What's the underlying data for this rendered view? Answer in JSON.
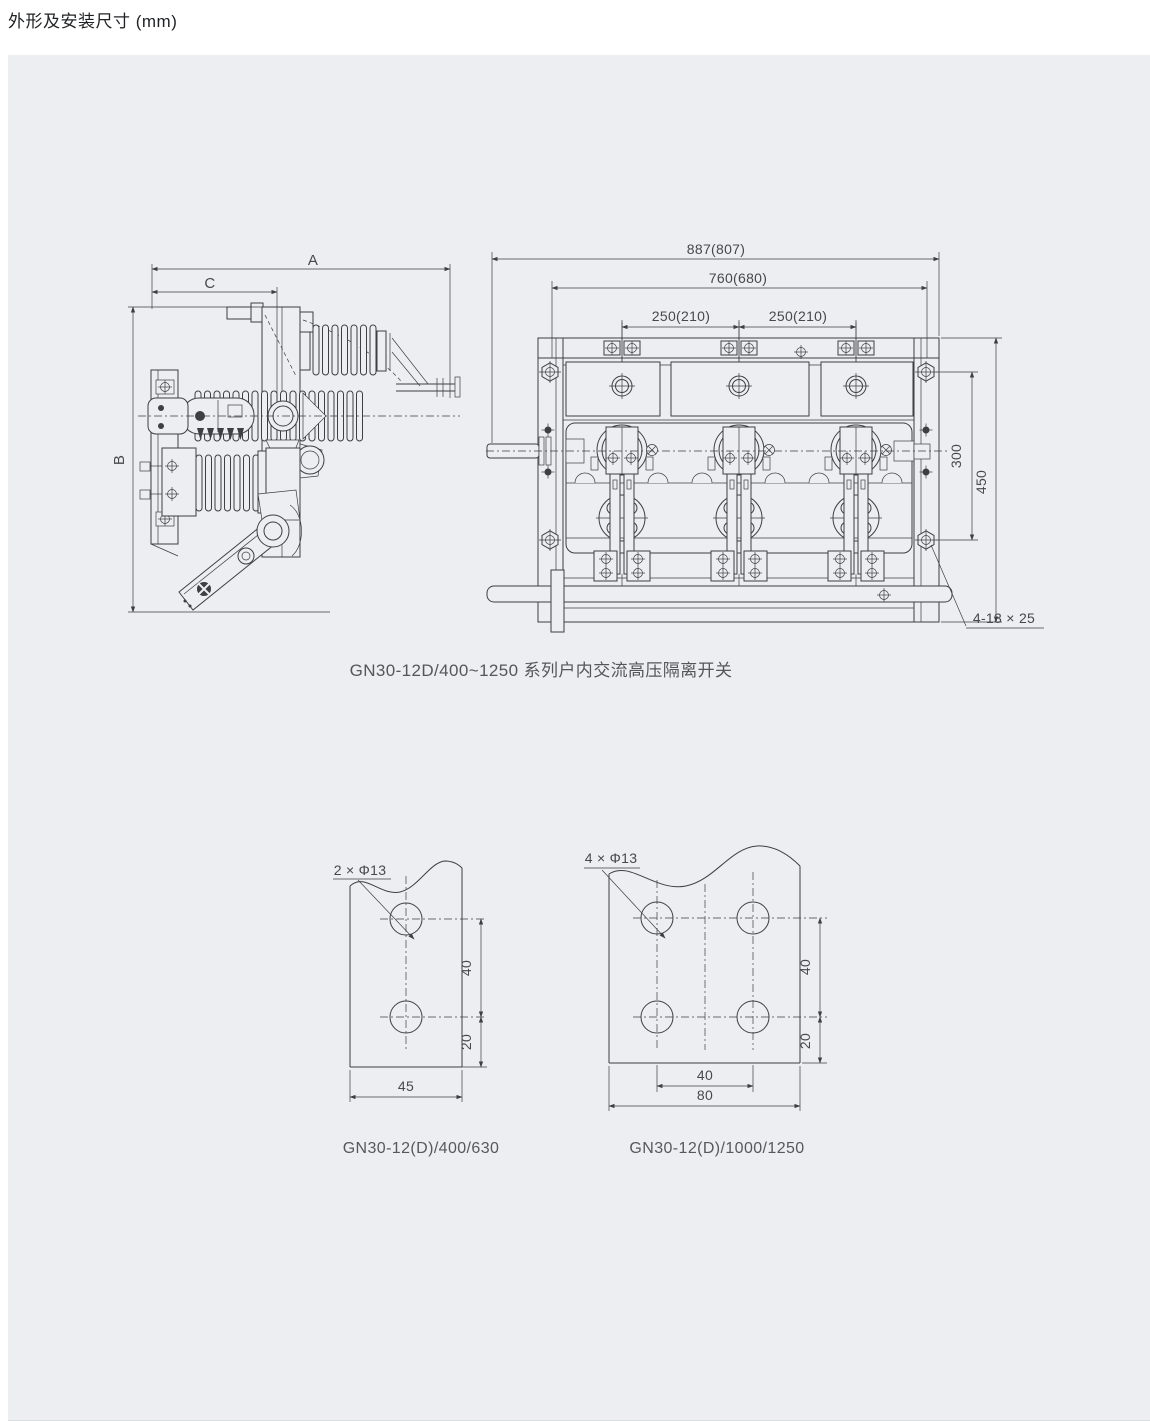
{
  "page": {
    "title": "外形及安装尺寸 (mm)"
  },
  "figure_main": {
    "caption": "GN30-12D/400~1250 系列户内交流高压隔离开关",
    "side_view": {
      "dim_width": "A",
      "dim_depth": "C",
      "dim_height": "B"
    },
    "front_view": {
      "dim_overall_width": "887(807)",
      "dim_mounting_width": "760(680)",
      "dim_pole_pitch_left": "250(210)",
      "dim_pole_pitch_right": "250(210)",
      "dim_hole_vertical": "300",
      "dim_height": "450",
      "label_mounting_holes": "4-13 × 25"
    }
  },
  "figure_plate_small": {
    "caption": "GN30-12(D)/400/630",
    "label_holes": "2 × Φ13",
    "dim_hole_pitch": "40",
    "dim_edge": "20",
    "dim_width": "45"
  },
  "figure_plate_large": {
    "caption": "GN30-12(D)/1000/1250",
    "label_holes": "4 × Φ13",
    "dim_hole_pitch_v": "40",
    "dim_edge": "20",
    "dim_hole_pitch_h": "40",
    "dim_width": "80"
  },
  "colors": {
    "panel_bg": "#eceef1",
    "line": "#3c4043",
    "dim_text": "#45494e",
    "caption_text": "#55595d",
    "title_text": "#1f2124"
  }
}
